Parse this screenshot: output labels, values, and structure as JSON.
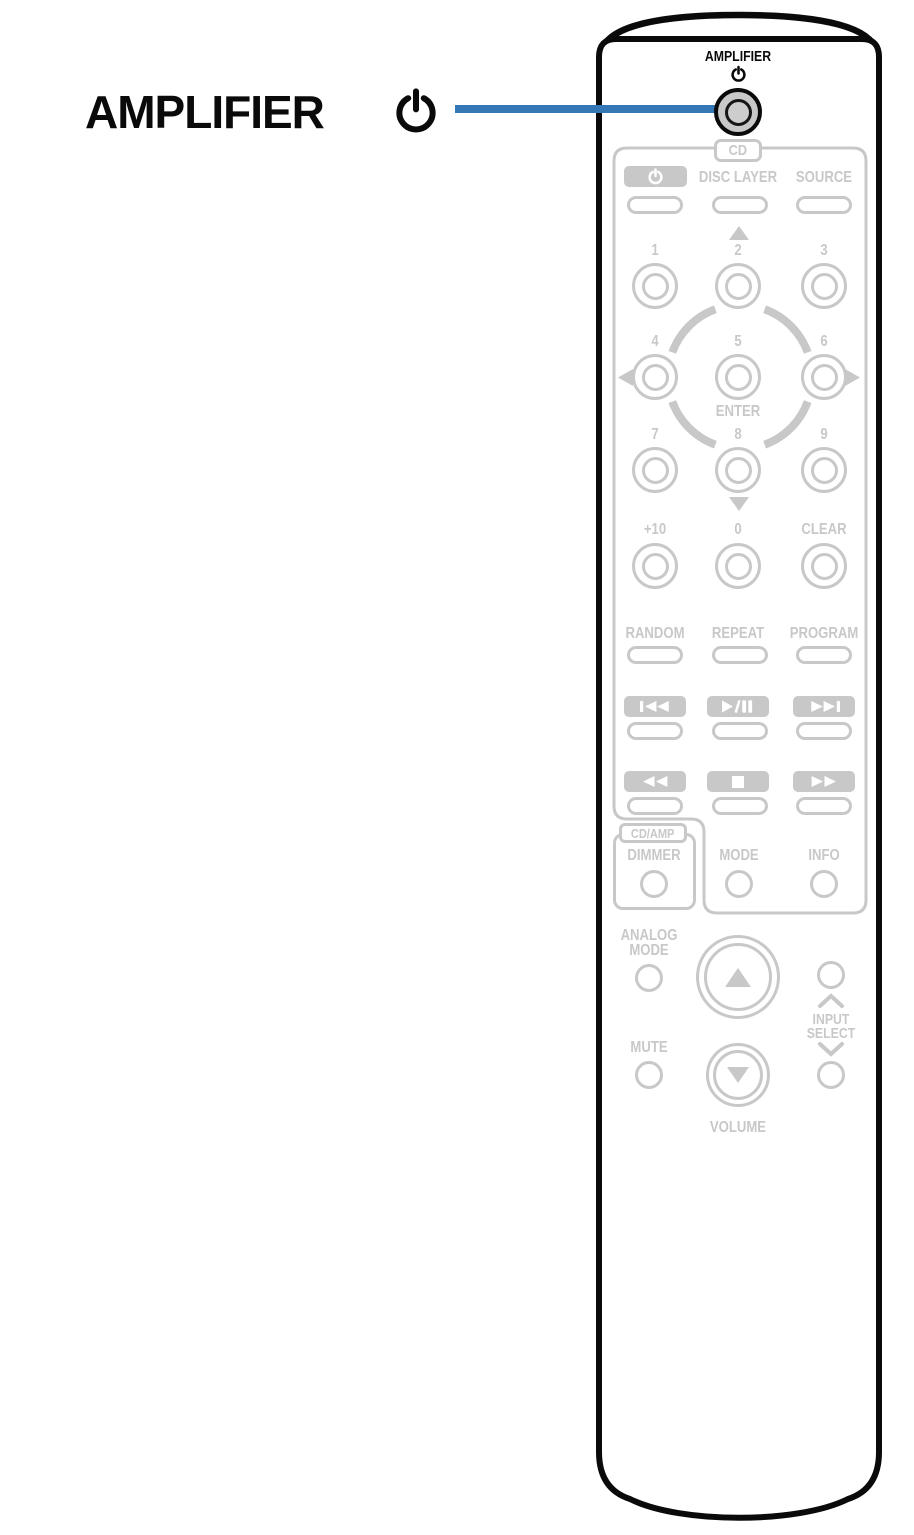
{
  "colors": {
    "accent_blue": "#3377b5",
    "ui_gray": "#c8c8c8",
    "outline_black": "#0a0a0a"
  },
  "callout": {
    "label": "AMPLIFIER",
    "icon": "power-icon"
  },
  "remote": {
    "power_button": {
      "label": "AMPLIFIER",
      "icon": "power-icon"
    },
    "cd": {
      "tag": "CD",
      "top_row": {
        "power_icon": "power-icon",
        "disc_layer": "DISC LAYER",
        "source": "SOURCE"
      },
      "keypad": {
        "digits": [
          "1",
          "2",
          "3",
          "4",
          "5",
          "6",
          "7",
          "8",
          "9"
        ],
        "enter": "ENTER"
      },
      "numeric": {
        "plus10": "+10",
        "zero": "0",
        "clear": "CLEAR"
      },
      "play_modes": {
        "random": "RANDOM",
        "repeat": "REPEAT",
        "program": "PROGRAM"
      },
      "transport_row1": [
        "skip-back-icon",
        "play-pause-icon",
        "skip-forward-icon"
      ],
      "transport_row2": [
        "rewind-icon",
        "stop-icon",
        "fast-forward-icon"
      ]
    },
    "cd_amp": {
      "tag": "CD/AMP",
      "dimmer": "DIMMER"
    },
    "mode_info": {
      "mode": "MODE",
      "info": "INFO"
    },
    "bottom": {
      "analog_line1": "ANALOG",
      "analog_line2": "MODE",
      "mute": "MUTE",
      "volume": "VOLUME",
      "input_line1": "INPUT",
      "input_line2": "SELECT"
    }
  },
  "icons": {
    "power-icon": "⏻",
    "skip-back-icon": "⏮",
    "play-pause-icon": "⏯",
    "skip-forward-icon": "⏭",
    "rewind-icon": "⏪",
    "stop-icon": "⏹",
    "fast-forward-icon": "⏩",
    "up-triangle-icon": "▲",
    "down-triangle-icon": "▼",
    "left-triangle-icon": "◀",
    "right-triangle-icon": "▶",
    "chevron-up-icon": "∧",
    "chevron-down-icon": "∨"
  }
}
